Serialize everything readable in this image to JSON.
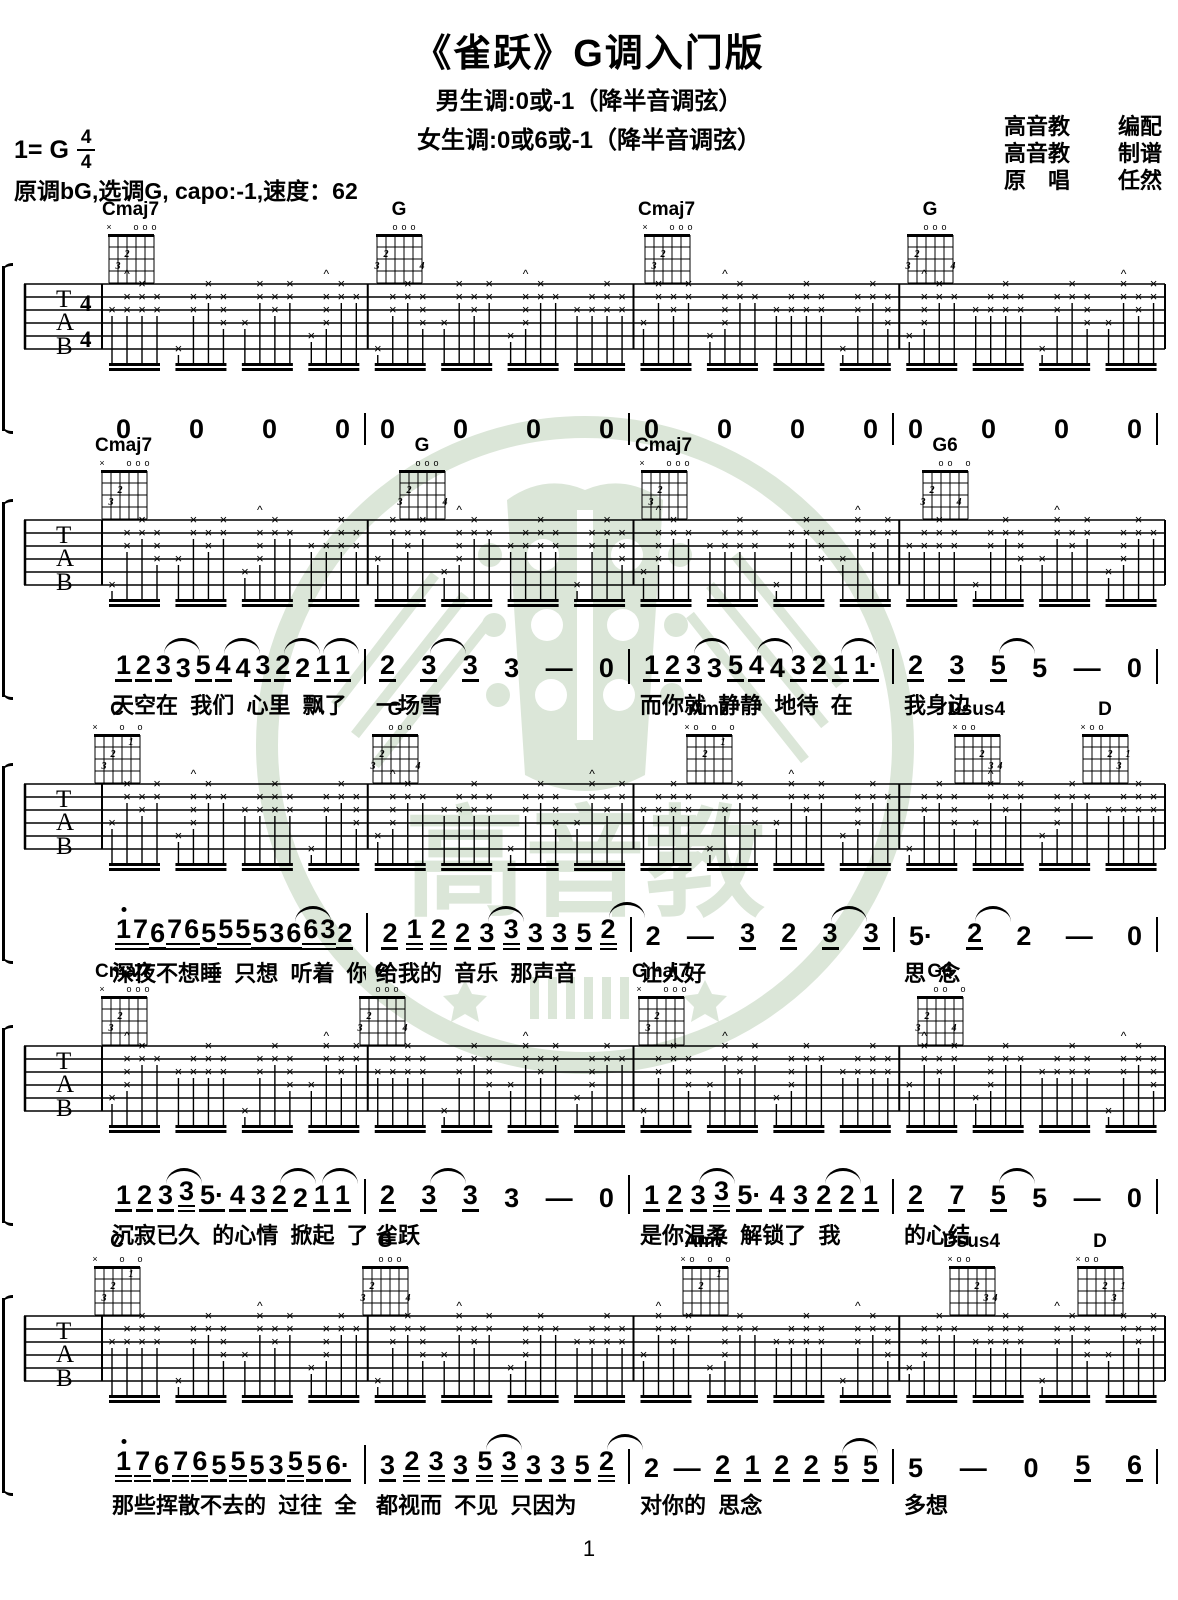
{
  "page": {
    "title": "《雀跃》G调入门版",
    "subtitle_male": "男生调:0或-1（降半音调弦）",
    "subtitle_female": "女生调:0或6或-1（降半音调弦）",
    "key_label": "1= G",
    "time_top": "4",
    "time_bottom": "4",
    "info_line": "原调bG,选调G, capo:-1,速度：62",
    "credits": [
      {
        "left": "高音教",
        "right": "编配"
      },
      {
        "left": "高音教",
        "right": "制谱"
      },
      {
        "left": "原　唱",
        "right": "任然"
      }
    ],
    "watermark_text": "高音教",
    "page_number": "1"
  },
  "tab": {
    "string_labels": [
      "T",
      "A",
      "B"
    ],
    "time_signature": "4/4",
    "strum_symbol": "×",
    "accent_symbol": "^"
  },
  "chord_shapes": {
    "Cmaj7": {
      "top": [
        "x",
        "",
        "",
        "o",
        "o",
        "o"
      ],
      "fingers": [
        {
          "s": 5,
          "f": 3,
          "t": "3"
        },
        {
          "s": 4,
          "f": 2,
          "t": "2"
        }
      ]
    },
    "G": {
      "top": [
        "",
        "",
        "o",
        "o",
        "o",
        ""
      ],
      "fingers": [
        {
          "s": 6,
          "f": 3,
          "t": "3"
        },
        {
          "s": 5,
          "f": 2,
          "t": "2"
        },
        {
          "s": 1,
          "f": 3,
          "t": "4"
        }
      ]
    },
    "G6": {
      "top": [
        "",
        "",
        "o",
        "o",
        "",
        "o"
      ],
      "fingers": [
        {
          "s": 6,
          "f": 3,
          "t": "3"
        },
        {
          "s": 5,
          "f": 2,
          "t": "2"
        },
        {
          "s": 2,
          "f": 3,
          "t": "4"
        }
      ]
    },
    "C": {
      "top": [
        "x",
        "",
        "",
        "o",
        "",
        "o"
      ],
      "fingers": [
        {
          "s": 5,
          "f": 3,
          "t": "3"
        },
        {
          "s": 4,
          "f": 2,
          "t": "2"
        },
        {
          "s": 2,
          "f": 1,
          "t": "1"
        }
      ]
    },
    "Am7": {
      "top": [
        "x",
        "o",
        "",
        "o",
        "",
        "o"
      ],
      "fingers": [
        {
          "s": 4,
          "f": 2,
          "t": "2"
        },
        {
          "s": 2,
          "f": 1,
          "t": "1"
        }
      ]
    },
    "Dsus4": {
      "top": [
        "x",
        "o",
        "o",
        "",
        "",
        ""
      ],
      "fingers": [
        {
          "s": 3,
          "f": 2,
          "t": "2"
        },
        {
          "s": 2,
          "f": 3,
          "t": "3"
        },
        {
          "s": 1,
          "f": 3,
          "t": "4"
        }
      ]
    },
    "D": {
      "top": [
        "x",
        "o",
        "o",
        "",
        "",
        ""
      ],
      "fingers": [
        {
          "s": 3,
          "f": 2,
          "t": "2"
        },
        {
          "s": 2,
          "f": 3,
          "t": "3"
        },
        {
          "s": 1,
          "f": 2,
          "t": "1"
        }
      ]
    }
  },
  "systems": [
    {
      "top": 200,
      "chords": [
        {
          "name": "Cmaj7",
          "x": 92
        },
        {
          "name": "G",
          "x": 362
        },
        {
          "name": "Cmaj7",
          "x": 628
        },
        {
          "name": "G",
          "x": 893
        }
      ],
      "jianpu": [
        [
          {
            "n": "0"
          },
          {
            "n": "0"
          },
          {
            "n": "0"
          },
          {
            "n": "0"
          }
        ],
        [
          {
            "n": "0"
          },
          {
            "n": "0"
          },
          {
            "n": "0"
          },
          {
            "n": "0"
          }
        ],
        [
          {
            "n": "0"
          },
          {
            "n": "0"
          },
          {
            "n": "0"
          },
          {
            "n": "0"
          }
        ],
        [
          {
            "n": "0"
          },
          {
            "n": "0"
          },
          {
            "n": "0"
          },
          {
            "n": "0"
          }
        ]
      ],
      "lyrics": [
        "",
        "",
        "",
        ""
      ]
    },
    {
      "top": 436,
      "chords": [
        {
          "name": "Cmaj7",
          "x": 85
        },
        {
          "name": "G",
          "x": 385
        },
        {
          "name": "Cmaj7",
          "x": 625
        },
        {
          "name": "G6",
          "x": 908
        }
      ],
      "jianpu": [
        [
          {
            "n": "1",
            "u": 1
          },
          {
            "n": "2",
            "u": 1
          },
          {
            "n": "3",
            "u": 1,
            "a": 1
          },
          {
            "n": "3"
          },
          {
            "n": "5",
            "u": 1
          },
          {
            "n": "4",
            "u": 1,
            "a": 1
          },
          {
            "n": "4"
          },
          {
            "n": "3",
            "u": 1
          },
          {
            "n": "2",
            "u": 1,
            "a": 1
          },
          {
            "n": "2"
          },
          {
            "n": "1",
            "u": 1,
            "a": 1
          },
          {
            "n": "1",
            "u": 1
          }
        ],
        [
          {
            "n": "2",
            "u": 1
          },
          {
            "n": "3",
            "u": 1,
            "a": 1
          },
          {
            "n": "3",
            "u": 1
          },
          {
            "n": "3"
          },
          {
            "n": "—"
          },
          {
            "n": "0"
          }
        ],
        [
          {
            "n": "1",
            "u": 1
          },
          {
            "n": "2",
            "u": 1
          },
          {
            "n": "3",
            "u": 1,
            "a": 1
          },
          {
            "n": "3"
          },
          {
            "n": "5",
            "u": 1
          },
          {
            "n": "4",
            "u": 1,
            "a": 1
          },
          {
            "n": "4"
          },
          {
            "n": "3",
            "u": 1
          },
          {
            "n": "2",
            "u": 1
          },
          {
            "n": "1",
            "u": 1,
            "a": 1
          },
          {
            "n": "1",
            "u": 1,
            "dot": 1
          }
        ],
        [
          {
            "n": "2",
            "u": 1
          },
          {
            "n": "3",
            "u": 1
          },
          {
            "n": "5",
            "u": 1,
            "a": 1
          },
          {
            "n": "5"
          },
          {
            "n": "—"
          },
          {
            "n": "0"
          }
        ]
      ],
      "lyrics": [
        "天空在  我们  心里  飘了",
        "一场雪",
        "而你就  静静  地待  在",
        "我身边"
      ]
    },
    {
      "top": 700,
      "chords": [
        {
          "name": "C",
          "x": 80
        },
        {
          "name": "G",
          "x": 358
        },
        {
          "name": "Am7",
          "x": 672
        },
        {
          "name": "Dsus4",
          "x": 938
        },
        {
          "name": "D",
          "x": 1068
        }
      ],
      "jianpu": [
        [
          {
            "n": "1",
            "hi": 1,
            "u": 2
          },
          {
            "n": "7",
            "u": 2
          },
          {
            "n": "6",
            "u": 1
          },
          {
            "n": "7",
            "u": 2
          },
          {
            "n": "6",
            "u": 2
          },
          {
            "n": "5",
            "u": 1
          },
          {
            "n": "5",
            "u": 2
          },
          {
            "n": "5",
            "u": 2
          },
          {
            "n": "5",
            "u": 1
          },
          {
            "n": "3",
            "u": 1
          },
          {
            "n": "6",
            "u": 1,
            "a": 1
          },
          {
            "n": "6",
            "u": 2
          },
          {
            "n": "3",
            "u": 2
          },
          {
            "n": "2",
            "u": 1
          }
        ],
        [
          {
            "n": "2",
            "u": 1
          },
          {
            "n": "1",
            "u": 2
          },
          {
            "n": "2",
            "u": 2
          },
          {
            "n": "2",
            "u": 1
          },
          {
            "n": "3",
            "u": 1,
            "a": 1
          },
          {
            "n": "3",
            "u": 2
          },
          {
            "n": "3",
            "u": 1
          },
          {
            "n": "3",
            "u": 1
          },
          {
            "n": "5",
            "u": 1
          },
          {
            "n": "2",
            "u": 2,
            "a": 1
          }
        ],
        [
          {
            "n": "2"
          },
          {
            "n": "—"
          },
          {
            "n": "3",
            "u": 1
          },
          {
            "n": "2",
            "u": 1
          },
          {
            "n": "3",
            "u": 1,
            "a": 1
          },
          {
            "n": "3",
            "u": 1
          }
        ],
        [
          {
            "n": "5",
            "dot": 1
          },
          {
            "n": "2",
            "u": 1,
            "a": 1
          },
          {
            "n": "2"
          },
          {
            "n": "—"
          },
          {
            "n": "0"
          }
        ]
      ],
      "lyrics": [
        "深夜不想睡  只想  听着  你",
        "给我的  音乐  那声音",
        "让人好",
        "思  念"
      ]
    },
    {
      "top": 962,
      "chords": [
        {
          "name": "Cmaj7",
          "x": 85
        },
        {
          "name": "G",
          "x": 345
        },
        {
          "name": "Cmaj7",
          "x": 622
        },
        {
          "name": "G6",
          "x": 903
        }
      ],
      "jianpu": [
        [
          {
            "n": "1",
            "u": 1
          },
          {
            "n": "2",
            "u": 1
          },
          {
            "n": "3",
            "u": 1,
            "a": 1
          },
          {
            "n": "3",
            "u": 2
          },
          {
            "n": "5",
            "u": 1,
            "dot": 1
          },
          {
            "n": "4",
            "u": 1
          },
          {
            "n": "3",
            "u": 1
          },
          {
            "n": "2",
            "u": 1,
            "a": 1
          },
          {
            "n": "2"
          },
          {
            "n": "1",
            "u": 1,
            "a": 1
          },
          {
            "n": "1",
            "u": 1
          }
        ],
        [
          {
            "n": "2",
            "u": 1
          },
          {
            "n": "3",
            "u": 1,
            "a": 1
          },
          {
            "n": "3",
            "u": 1
          },
          {
            "n": "3"
          },
          {
            "n": "—"
          },
          {
            "n": "0"
          }
        ],
        [
          {
            "n": "1",
            "u": 1
          },
          {
            "n": "2",
            "u": 1
          },
          {
            "n": "3",
            "u": 1,
            "a": 1
          },
          {
            "n": "3",
            "u": 2
          },
          {
            "n": "5",
            "u": 1,
            "dot": 1
          },
          {
            "n": "4",
            "u": 1
          },
          {
            "n": "3",
            "u": 1
          },
          {
            "n": "2",
            "u": 1,
            "a": 1
          },
          {
            "n": "2",
            "u": 1
          },
          {
            "n": "1",
            "u": 1
          }
        ],
        [
          {
            "n": "2",
            "u": 1
          },
          {
            "n": "7",
            "u": 1
          },
          {
            "n": "5",
            "u": 1,
            "a": 1
          },
          {
            "n": "5"
          },
          {
            "n": "—"
          },
          {
            "n": "0"
          }
        ]
      ],
      "lyrics": [
        "沉寂已久  的心情  掀起  了",
        "雀跃",
        "是你温柔  解锁了  我",
        "的心结"
      ]
    },
    {
      "top": 1232,
      "chords": [
        {
          "name": "C",
          "x": 80
        },
        {
          "name": "G",
          "x": 348
        },
        {
          "name": "Am7",
          "x": 668
        },
        {
          "name": "Dsus4",
          "x": 933
        },
        {
          "name": "D",
          "x": 1063
        }
      ],
      "jianpu": [
        [
          {
            "n": "1",
            "hi": 1,
            "u": 2
          },
          {
            "n": "7",
            "u": 2
          },
          {
            "n": "6",
            "u": 1
          },
          {
            "n": "7",
            "u": 2
          },
          {
            "n": "6",
            "u": 2
          },
          {
            "n": "5",
            "u": 1
          },
          {
            "n": "5",
            "u": 2
          },
          {
            "n": "5",
            "u": 1
          },
          {
            "n": "3",
            "u": 1
          },
          {
            "n": "5",
            "u": 2
          },
          {
            "n": "5",
            "u": 1
          },
          {
            "n": "6",
            "u": 1,
            "dot": 1
          }
        ],
        [
          {
            "n": "3",
            "u": 1
          },
          {
            "n": "2",
            "u": 2
          },
          {
            "n": "3",
            "u": 2
          },
          {
            "n": "3",
            "u": 1
          },
          {
            "n": "5",
            "u": 2,
            "a": 1
          },
          {
            "n": "3",
            "u": 2
          },
          {
            "n": "3",
            "u": 1
          },
          {
            "n": "3",
            "u": 1
          },
          {
            "n": "5",
            "u": 1
          },
          {
            "n": "2",
            "u": 2,
            "a": 1
          }
        ],
        [
          {
            "n": "2"
          },
          {
            "n": "—"
          },
          {
            "n": "2",
            "u": 1
          },
          {
            "n": "1",
            "u": 1
          },
          {
            "n": "2",
            "u": 1
          },
          {
            "n": "2",
            "u": 1
          },
          {
            "n": "5",
            "u": 1,
            "a": 1
          },
          {
            "n": "5",
            "u": 1
          }
        ],
        [
          {
            "n": "5"
          },
          {
            "n": "—"
          },
          {
            "n": "0"
          },
          {
            "n": "5",
            "u": 1
          },
          {
            "n": "6",
            "u": 1
          }
        ]
      ],
      "lyrics": [
        "那些挥散不去的  过往  全",
        "都视而  不见  只因为",
        "对你的  思念",
        "多想"
      ]
    }
  ]
}
